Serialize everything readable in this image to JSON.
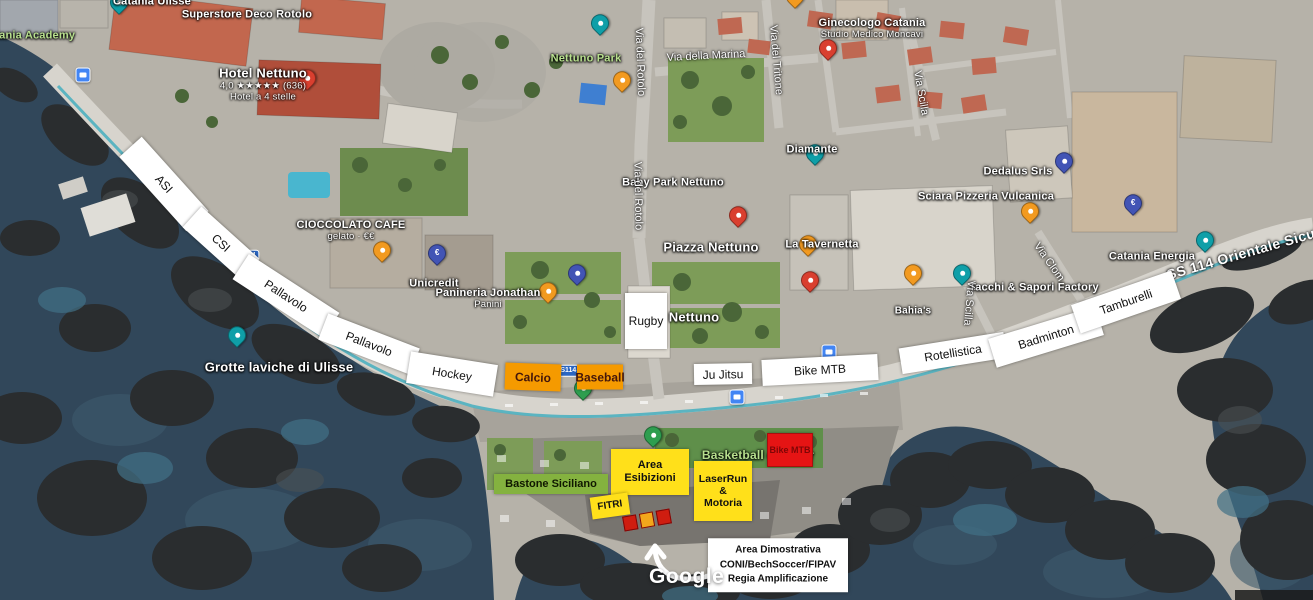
{
  "map": {
    "watermark": "Google",
    "colors": {
      "sea": "#31475a",
      "land": "#b6b2a9",
      "park": "#7d9c58",
      "road": "#d7d4cd",
      "bike_lane": "#45aebe",
      "label_white": "#ffffff",
      "label_green": "#b8e08e",
      "box_yellow": "#ffe01a",
      "box_orange": "#f59a00",
      "box_red": "#e51414",
      "box_green": "#84b23f",
      "pin_teal": "#0f9fa8",
      "pin_orange": "#f29a20",
      "pin_red": "#d93f2f",
      "pin_navy": "#4254b5",
      "pin_green": "#2e9e4f",
      "transit_blue": "#4285f4",
      "shield_blue": "#2b66c2"
    },
    "place_labels": [
      {
        "name": "label-catania-ulisse",
        "text": "Catania Ulisse",
        "x": 152,
        "y": 2
      },
      {
        "name": "label-catania-academy",
        "text": "Catania Academy",
        "x": 28,
        "y": 36,
        "green": true
      },
      {
        "name": "label-superstore-deco-rotolo",
        "text": "Superstore Deco Rotolo",
        "x": 247,
        "y": 15
      },
      {
        "name": "label-hotel-nettuno",
        "text": "Hotel Nettuno",
        "x": 263,
        "y": 85,
        "size": 13,
        "subs": [
          "4,0 ★★★★★ (636)",
          "Hotel a 4 stelle"
        ]
      },
      {
        "name": "label-nettuno-park",
        "text": "Nettuno Park",
        "x": 586,
        "y": 59,
        "green": true
      },
      {
        "name": "label-ginecologo-catania",
        "text": "Ginecologo Catania",
        "x": 872,
        "y": 29,
        "subs": [
          "Studio Medico Moncavi"
        ]
      },
      {
        "name": "label-baby-park-nettuno",
        "text": "Baby Park Nettuno",
        "x": 673,
        "y": 183
      },
      {
        "name": "label-diamante",
        "text": "Diamante",
        "x": 812,
        "y": 150
      },
      {
        "name": "label-piazza-nettuno",
        "text": "Piazza Nettuno",
        "x": 711,
        "y": 248,
        "size": 13
      },
      {
        "name": "label-la-tavernetta",
        "text": "La Tavernetta",
        "x": 822,
        "y": 245
      },
      {
        "name": "label-dedalus",
        "text": "Dedalus Srls",
        "x": 1018,
        "y": 172
      },
      {
        "name": "label-sciara-pizzeria-vulcanica",
        "text": "Sciara Pizzeria Vulcanica",
        "x": 986,
        "y": 197
      },
      {
        "name": "label-tacchi-sapori-factory",
        "text": "Tacchi & Sapori Factory",
        "x": 1034,
        "y": 288
      },
      {
        "name": "label-catania-energia",
        "text": "Catania Energia",
        "x": 1152,
        "y": 257
      },
      {
        "name": "label-grotte-laviche-di-ulisse",
        "text": "Grotte laviche di Ulisse",
        "x": 279,
        "y": 368,
        "size": 13
      },
      {
        "name": "label-cioccolato-cafe",
        "text": "CIOCCOLATO CAFE",
        "x": 351,
        "y": 231,
        "subs": [
          "gelato · €€"
        ]
      },
      {
        "name": "label-unicredit",
        "text": "Unicredit",
        "x": 434,
        "y": 284
      },
      {
        "name": "label-panineria-jonathan",
        "text": "Panineria Jonathan",
        "x": 488,
        "y": 299,
        "subs": [
          "Panini"
        ]
      },
      {
        "name": "label-nettuno-partial",
        "text": "Nettuno",
        "x": 694,
        "y": 318,
        "size": 13
      },
      {
        "name": "label-basketball-outdoor",
        "text": "Basketball outdoor",
        "x": 758,
        "y": 456,
        "green": true,
        "size": 12
      },
      {
        "name": "label-bahias",
        "text": "Bahia's",
        "x": 913,
        "y": 311,
        "size": 10
      }
    ],
    "street_labels": [
      {
        "name": "street-via-del-rotolo-upper",
        "text": "Via del Rotolo",
        "x": 640,
        "y": 62,
        "rotate": 88
      },
      {
        "name": "street-via-del-rotolo-lower",
        "text": "Via del Rotolo",
        "x": 638,
        "y": 196,
        "rotate": 89
      },
      {
        "name": "street-via-della-marina",
        "text": "Via della Marina",
        "x": 706,
        "y": 56,
        "rotate": -3
      },
      {
        "name": "street-via-del-tritone",
        "text": "Via del Tritone",
        "x": 776,
        "y": 60,
        "rotate": 85
      },
      {
        "name": "street-via-scilla-upper",
        "text": "Via Scilla",
        "x": 921,
        "y": 93,
        "rotate": 80
      },
      {
        "name": "street-via-scilla-lower",
        "text": "Via Scilla",
        "x": 969,
        "y": 303,
        "rotate": 95
      },
      {
        "name": "street-via-clom",
        "text": "Via Clom",
        "x": 1049,
        "y": 262,
        "rotate": 55
      },
      {
        "name": "street-ss114-orientale-sicula",
        "text": "SS 114 Orientale Sicula",
        "x": 1247,
        "y": 252,
        "rotate": -16,
        "big": true
      }
    ],
    "road_shields": [
      {
        "name": "road-shield-114",
        "text": "114",
        "x": 250,
        "y": 256
      },
      {
        "name": "road-shield-ss114",
        "text": "SS114",
        "x": 566,
        "y": 371
      }
    ],
    "pins": [
      {
        "name": "pin-catania-ulisse",
        "color": "teal",
        "x": 119,
        "y": 14
      },
      {
        "name": "pin-nettuno-park",
        "color": "teal",
        "x": 600,
        "y": 35
      },
      {
        "name": "pin-diamante",
        "color": "teal",
        "x": 815,
        "y": 165
      },
      {
        "name": "pin-grotte-laviche",
        "color": "teal",
        "x": 237,
        "y": 347
      },
      {
        "name": "pin-via-scilla-area",
        "color": "teal",
        "x": 962,
        "y": 285
      },
      {
        "name": "pin-catania-energia",
        "color": "teal",
        "x": 1205,
        "y": 252
      },
      {
        "name": "pin-food-via-rotolo",
        "color": "orange",
        "x": 622,
        "y": 92
      },
      {
        "name": "pin-food-top",
        "color": "orange",
        "x": 795,
        "y": 8
      },
      {
        "name": "pin-cioccolato-cafe",
        "color": "orange",
        "x": 382,
        "y": 262
      },
      {
        "name": "pin-panineria-jonathan",
        "color": "orange",
        "x": 548,
        "y": 303
      },
      {
        "name": "pin-la-tavernetta",
        "color": "orange",
        "x": 808,
        "y": 256
      },
      {
        "name": "pin-bahias",
        "color": "orange",
        "x": 913,
        "y": 285
      },
      {
        "name": "pin-sciara-pizzeria",
        "color": "orange",
        "x": 1030,
        "y": 223
      },
      {
        "name": "pin-hotel-nettuno",
        "color": "red",
        "x": 307,
        "y": 90
      },
      {
        "name": "pin-studio-medico",
        "color": "red",
        "x": 828,
        "y": 60
      },
      {
        "name": "pin-piazza-nettuno",
        "color": "red",
        "x": 738,
        "y": 227
      },
      {
        "name": "pin-shop-lungomare",
        "color": "red",
        "x": 810,
        "y": 292
      },
      {
        "name": "pin-unicredit",
        "color": "navy",
        "glyph": "€",
        "x": 437,
        "y": 265
      },
      {
        "name": "pin-pet-area",
        "color": "navy",
        "x": 577,
        "y": 285
      },
      {
        "name": "pin-dedalus",
        "color": "navy",
        "x": 1064,
        "y": 173
      },
      {
        "name": "pin-bank-energia",
        "color": "navy",
        "glyph": "€",
        "x": 1133,
        "y": 215
      },
      {
        "name": "pin-lungomare-green",
        "color": "green",
        "x": 583,
        "y": 400
      },
      {
        "name": "pin-basketball-green",
        "color": "green",
        "x": 653,
        "y": 447
      }
    ],
    "transit_stops": [
      {
        "x": 83,
        "y": 75
      },
      {
        "x": 829,
        "y": 352
      },
      {
        "x": 737,
        "y": 397
      }
    ],
    "sport_labels": [
      {
        "text": "ASI",
        "x": 164,
        "y": 184,
        "w": 100,
        "h": 30,
        "r": 48
      },
      {
        "text": "CSI",
        "x": 221,
        "y": 243,
        "w": 78,
        "h": 28,
        "r": 42
      },
      {
        "text": "Pallavolo",
        "x": 286,
        "y": 296,
        "w": 108,
        "h": 30,
        "r": 33
      },
      {
        "text": "Pallavolo",
        "x": 369,
        "y": 344,
        "w": 98,
        "h": 28,
        "r": 21
      },
      {
        "text": "Hockey",
        "x": 452,
        "y": 374,
        "w": 88,
        "h": 32,
        "r": 9
      },
      {
        "text": "Calcio",
        "x": 533,
        "y": 377,
        "w": 56,
        "h": 27,
        "r": 2,
        "orange": true
      },
      {
        "text": "Baseball",
        "x": 600,
        "y": 377,
        "w": 46,
        "h": 25,
        "r": 0,
        "orange": true
      },
      {
        "text": "Rugby",
        "x": 646,
        "y": 321,
        "w": 42,
        "h": 56,
        "r": 0
      },
      {
        "text": "Ju Jitsu",
        "x": 723,
        "y": 374,
        "w": 58,
        "h": 21,
        "r": -1
      },
      {
        "text": "Bike MTB",
        "x": 820,
        "y": 370,
        "w": 116,
        "h": 26,
        "r": -3
      },
      {
        "text": "Rotellistica",
        "x": 953,
        "y": 353,
        "w": 106,
        "h": 26,
        "r": -9
      },
      {
        "text": "Badminton",
        "x": 1046,
        "y": 337,
        "w": 112,
        "h": 30,
        "r": -17
      },
      {
        "text": "Tamburelli",
        "x": 1126,
        "y": 302,
        "w": 106,
        "h": 30,
        "r": -19
      }
    ],
    "event_boxes": [
      {
        "name": "event-bastone-siciliano",
        "lines": [
          "Bastone Siciliano"
        ],
        "x": 551,
        "y": 484,
        "w": 114,
        "h": 20,
        "bg": "#84b23f",
        "color": "#101800",
        "fs": 11,
        "r": 0
      },
      {
        "name": "event-area-esibizioni",
        "lines": [
          "Area Esibizioni"
        ],
        "x": 650,
        "y": 472,
        "w": 78,
        "h": 46,
        "bg": "#ffe01a",
        "color": "#111111",
        "fs": 11,
        "r": 0
      },
      {
        "name": "event-laserrun-motoria",
        "lines": [
          "LaserRun",
          "&",
          "Motoria"
        ],
        "x": 723,
        "y": 491,
        "w": 58,
        "h": 60,
        "bg": "#ffe01a",
        "color": "#111111",
        "fs": 10.5,
        "r": 0
      },
      {
        "name": "event-fitri",
        "lines": [
          "FITRI"
        ],
        "x": 610,
        "y": 506,
        "w": 38,
        "h": 22,
        "bg": "#ffe01a",
        "color": "#111111",
        "fs": 10,
        "r": -8
      },
      {
        "name": "event-bike-mtb",
        "lines": [
          "Bike MTB"
        ],
        "x": 790,
        "y": 450,
        "w": 44,
        "h": 32,
        "bg": "#e51414",
        "color": "#7e0606",
        "fs": 9,
        "r": 0,
        "border": "1px solid #a80f0f"
      }
    ],
    "demo_markers": {
      "x": 647,
      "y": 520,
      "r": -10,
      "colors": [
        "#cf1d10",
        "#f2a71b",
        "#cf1d10"
      ]
    },
    "note": {
      "name": "demo-area-note",
      "lines": [
        "Area Dimostrativa",
        "CONI/BechSoccer/FIPAV",
        "Regia Amplificazione"
      ],
      "x": 778,
      "y": 565,
      "w": 132
    }
  }
}
